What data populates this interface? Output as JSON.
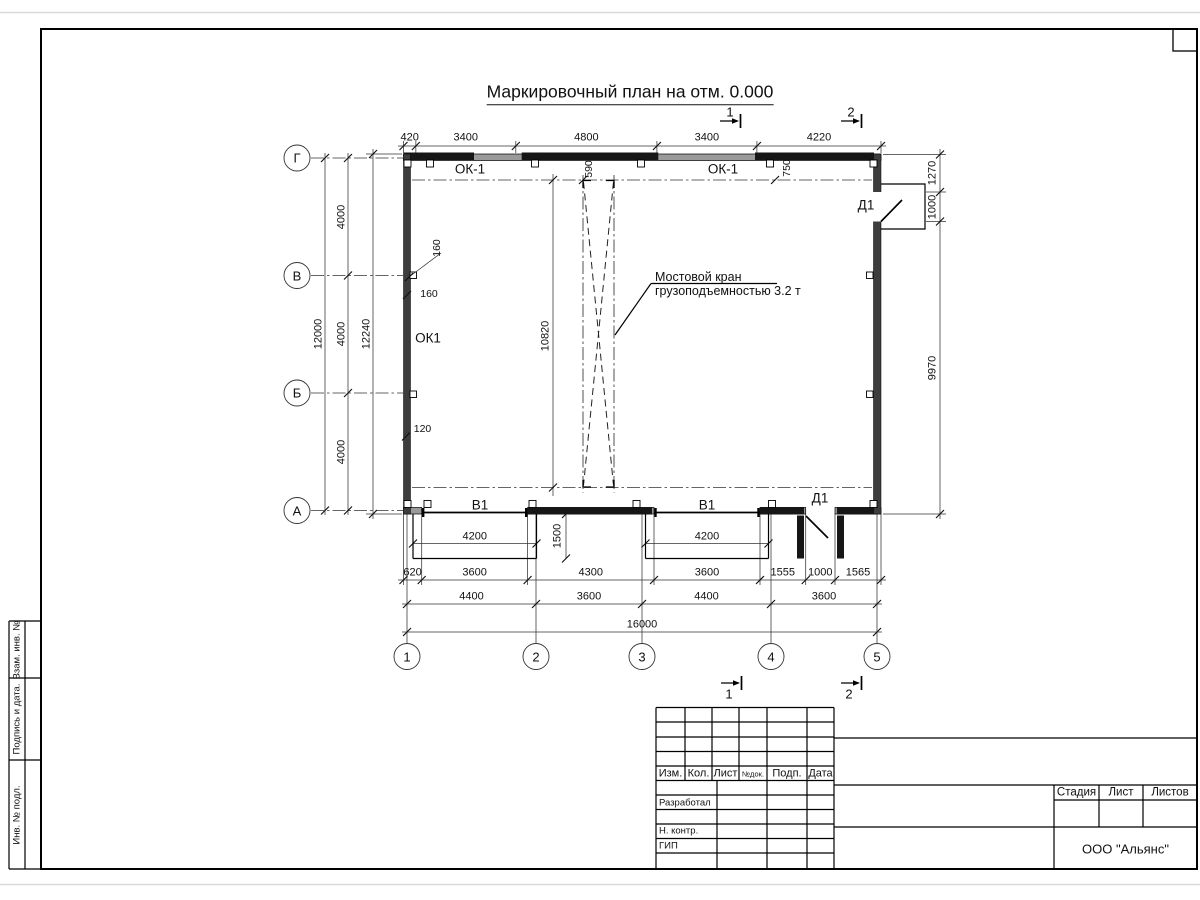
{
  "drawing_title": "Маркировочный план на отм. 0.000",
  "crane_note": {
    "line1": "Мостовой кран",
    "line2": "грузоподъемностью 3.2 т"
  },
  "axes": {
    "rows": [
      "Г",
      "В",
      "Б",
      "А"
    ],
    "cols": [
      "1",
      "2",
      "3",
      "4",
      "5"
    ]
  },
  "labels": {
    "windows": [
      "ОК-1",
      "ОК-1"
    ],
    "room": "ОК1",
    "gates": [
      "В1",
      "В1"
    ],
    "doors": [
      "Д1",
      "Д1"
    ]
  },
  "section_marks": [
    "1",
    "2"
  ],
  "dims": {
    "top": [
      "420",
      "3400",
      "4800",
      "3400",
      "4220"
    ],
    "left_chain": [
      "4000",
      "4000",
      "4000"
    ],
    "left_total": "12000",
    "left_overall": "12240",
    "right": [
      "1270",
      "1000",
      "9970"
    ],
    "crane_span": "10820",
    "crane_offsets": [
      "590",
      "750"
    ],
    "wall_marks": [
      "160",
      "160",
      "120"
    ],
    "gate_width": [
      "4200",
      "4200"
    ],
    "recess_depth": "1500",
    "bottom_row1": [
      "620",
      "3600",
      "4300",
      "3600",
      "1555",
      "1000",
      "1565"
    ],
    "bottom_row2": [
      "4400",
      "3600",
      "4400",
      "3600"
    ],
    "bottom_total": "16000"
  },
  "titleblock": {
    "header": [
      "Изм.",
      "Кол.",
      "Лист",
      "№док.",
      "Подп.",
      "Дата"
    ],
    "roles": [
      "Разработал",
      "Н. контр.",
      "ГИП"
    ],
    "stage_header": [
      "Стадия",
      "Лист",
      "Листов"
    ],
    "company": "ООО \"Альянс\""
  },
  "side_stamp": [
    "Взам. инв. №",
    "Подпись и дата.",
    "Инв. № подл."
  ]
}
